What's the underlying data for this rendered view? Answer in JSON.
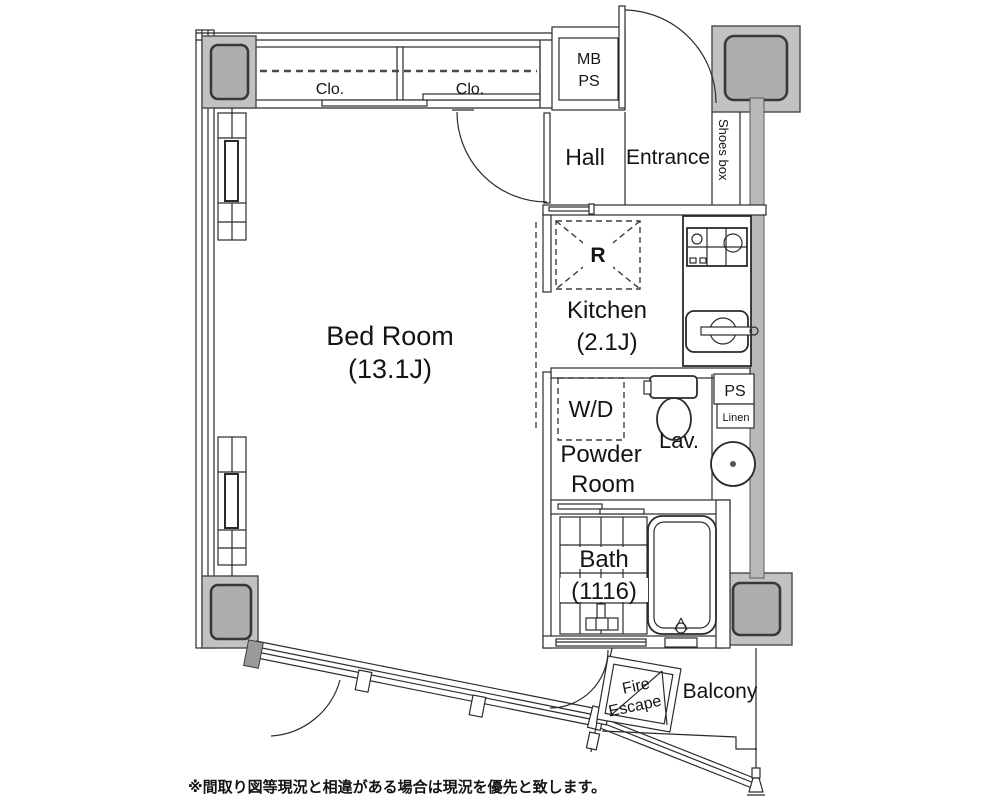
{
  "plan": {
    "labels": {
      "bedroom_name": "Bed Room",
      "bedroom_size": "(13.1J)",
      "kitchen_name": "Kitchen",
      "kitchen_size": "(2.1J)",
      "hall": "Hall",
      "entrance": "Entrance",
      "shoes_box": "Shoes box",
      "mb": "MB",
      "ps_meter": "PS",
      "closet_left": "Clo.",
      "closet_right": "Clo.",
      "wd": "W/D",
      "powder_line1": "Powder",
      "powder_line2": "Room",
      "lav": "Lav.",
      "ps_shaft": "PS",
      "linen": "Linen",
      "bath_name": "Bath",
      "bath_size": "(1116)",
      "balcony": "Balcony",
      "fire_line1": "Fire",
      "fire_line2": "Escape",
      "refrigerator": "R",
      "note": "※間取り図等現況と相違がある場合は現況を優先と致します。"
    },
    "colors": {
      "background": "#ffffff",
      "line": "#2b2b2b",
      "pillar": "#c2c2c2",
      "pillar_inner": "#aeaeae",
      "wall_gray": "#b9b9b9",
      "text": "#141414"
    }
  }
}
